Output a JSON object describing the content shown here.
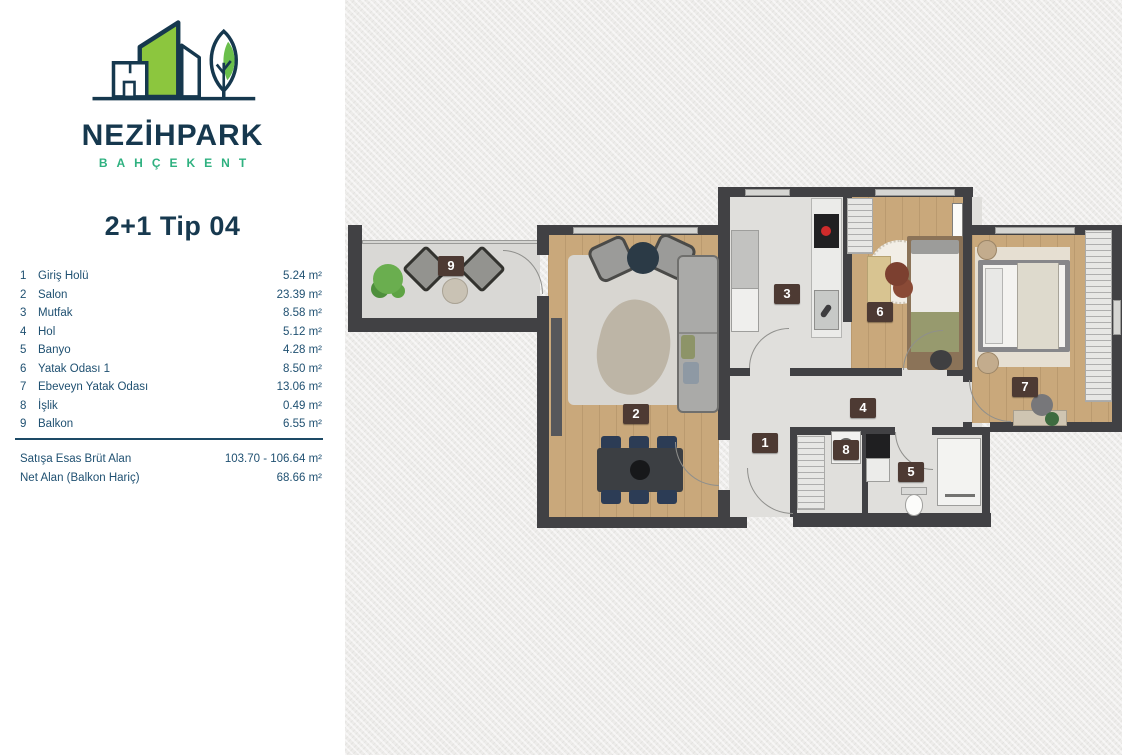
{
  "brand": {
    "name": "NEZİHPARK",
    "subtitle": "BAHÇEKENT"
  },
  "plan_title": "2+1 Tip 04",
  "unit": {
    "rooms": [
      {
        "no": "1",
        "name": "Giriş Holü",
        "area": "5.24 m²",
        "label_x": 420,
        "label_y": 443
      },
      {
        "no": "2",
        "name": "Salon",
        "area": "23.39 m²",
        "label_x": 291,
        "label_y": 414
      },
      {
        "no": "3",
        "name": "Mutfak",
        "area": "8.58 m²",
        "label_x": 442,
        "label_y": 294
      },
      {
        "no": "4",
        "name": "Hol",
        "area": "5.12 m²",
        "label_x": 518,
        "label_y": 408
      },
      {
        "no": "5",
        "name": "Banyo",
        "area": "4.28 m²",
        "label_x": 566,
        "label_y": 472
      },
      {
        "no": "6",
        "name": "Yatak Odası 1",
        "area": "8.50 m²",
        "label_x": 535,
        "label_y": 312
      },
      {
        "no": "7",
        "name": "Ebeveyn Yatak Odası",
        "area": "13.06 m²",
        "label_x": 680,
        "label_y": 387
      },
      {
        "no": "8",
        "name": "İşlik",
        "area": "0.49 m²",
        "label_x": 501,
        "label_y": 450
      },
      {
        "no": "9",
        "name": "Balkon",
        "area": "6.55 m²",
        "label_x": 106,
        "label_y": 266
      }
    ],
    "summary": [
      {
        "label": "Satışa Esas Brüt Alan",
        "value": "103.70 - 106.64 m²"
      },
      {
        "label": "Net Alan (Balkon Hariç)",
        "value": "68.66 m²"
      }
    ]
  },
  "colors": {
    "navy": "#16384e",
    "table_text": "#1f5071",
    "logo_green": "#8cc63e",
    "subtitle_green": "#2fb180",
    "room_label_bg": "#4d3a33",
    "wall": "#414144",
    "wood_floor": "#c9a87b",
    "light_floor": "#e0dfdc"
  }
}
